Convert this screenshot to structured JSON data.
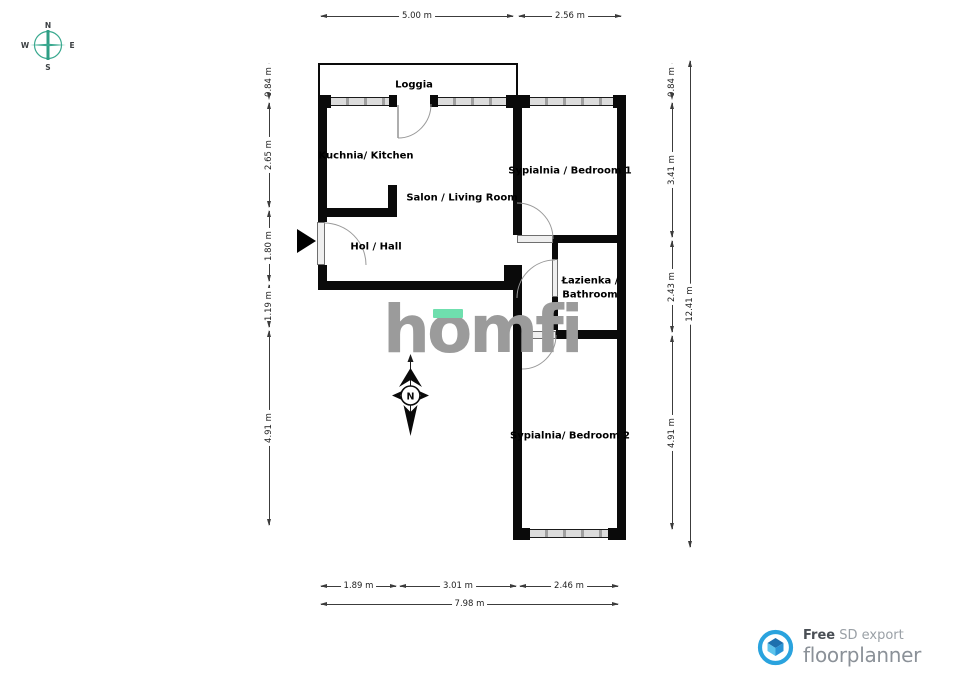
{
  "compass_rose": {
    "n": "N",
    "e": "E",
    "s": "S",
    "w": "W",
    "color": "#3aa98f"
  },
  "rooms": {
    "loggia": "Loggia",
    "kitchen": "Kuchnia/ Kitchen",
    "living": "Salon / Living Room",
    "hall": "Hol / Hall",
    "bedroom1": "Sypialnia / Bedroom 1",
    "bathroom_line1": "Łazienka /",
    "bathroom_line2": "Bathroom",
    "bedroom2": "Sypialnia/ Bedroom 2"
  },
  "dims": {
    "top": [
      "5.00 m",
      "2.56 m"
    ],
    "left": [
      "0.84 m",
      "2.65 m",
      "1.80 m",
      "1.19 m",
      "4.91 m"
    ],
    "right": [
      "0.84 m",
      "3.41 m",
      "2.43 m",
      "4.91 m"
    ],
    "right_total": "12.41 m",
    "bottom": [
      "1.89 m",
      "3.01 m",
      "2.46 m"
    ],
    "bottom_total": "7.98 m"
  },
  "watermark": {
    "part1": "h",
    "part2": "o",
    "part3": "mfi",
    "accent_color": "#6fdfae",
    "text_color": "#9b9b9b"
  },
  "north_indicator": {
    "label": "N"
  },
  "footer": {
    "free": "Free",
    "export": "SD export",
    "brand": "floorplanner",
    "brand_color": "#2aa3de"
  }
}
